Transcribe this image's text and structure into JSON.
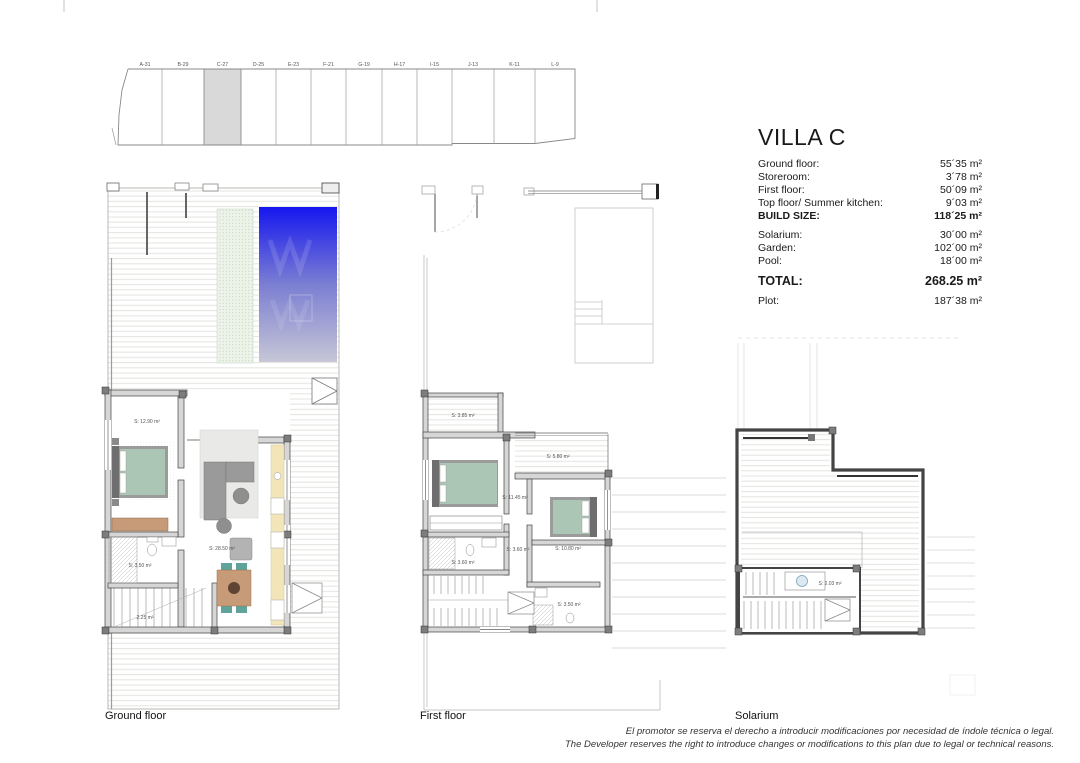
{
  "site_plan": {
    "plots": [
      "A-31",
      "B-29",
      "C-27",
      "D-25",
      "E-23",
      "F-21",
      "G-19",
      "H-17",
      "I-15",
      "J-13",
      "K-11",
      "L-9"
    ],
    "highlighted_plot": "C-27"
  },
  "info": {
    "title": "VILLA C",
    "rows": [
      {
        "label": "Ground floor:",
        "value": "55´35 m²"
      },
      {
        "label": "Storeroom:",
        "value": "3´78 m²"
      },
      {
        "label": "First floor:",
        "value": "50´09 m²"
      },
      {
        "label": "Top floor/ Summer kitchen:",
        "value": "9´03 m²"
      },
      {
        "label": "BUILD SIZE:",
        "value": "118´25 m²"
      },
      {
        "label": "Solarium:",
        "value": "30´00 m²"
      },
      {
        "label": "Garden:",
        "value": "102´00 m²"
      },
      {
        "label": "Pool:",
        "value": "18´00 m²"
      },
      {
        "label": "TOTAL:",
        "value": "268.25 m²"
      },
      {
        "label": "Plot:",
        "value": "187´38 m²"
      }
    ]
  },
  "plans": {
    "ground": {
      "label": "Ground floor",
      "rooms": {
        "bedroom": "S: 12.90 m²",
        "living": "S: 28.50 m²",
        "bathroom": "S: 3.50 m²",
        "stairs": "2.25 m²"
      }
    },
    "first": {
      "label": "First floor",
      "rooms": {
        "terrace_top": "S: 3.85 m²",
        "terrace_right": "S: 5.80 m²",
        "bedroom1": "S: 11.45 m²",
        "bedroom2": "S: 10.80 m²",
        "bathroom1": "S: 3.60 m²",
        "hall": "S: 3.60 m²",
        "bathroom2": "S: 3.50 m²"
      }
    },
    "solarium": {
      "label": "Solarium",
      "rooms": {
        "storeroom": "S: 2.03 m²"
      }
    }
  },
  "disclaimer": {
    "line_es": "El promotor se reserva el derecho a introducir modificaciones por necesidad de índole técnica o legal.",
    "line_en": "The Developer reserves the right to introduce changes or modifications to this plan due to legal or technical reasons."
  },
  "colors": {
    "pool_top": "#1617ef",
    "pool_mid": "#7b7ed2",
    "pool_bottom": "#c6c6d6",
    "plot_highlight": "#d9d9d9",
    "bed_mattress": "#abc6b5",
    "wood_tan": "#c79b77",
    "chair_teal": "#5fa39b",
    "kitchen_cream": "#f3e5ba"
  }
}
